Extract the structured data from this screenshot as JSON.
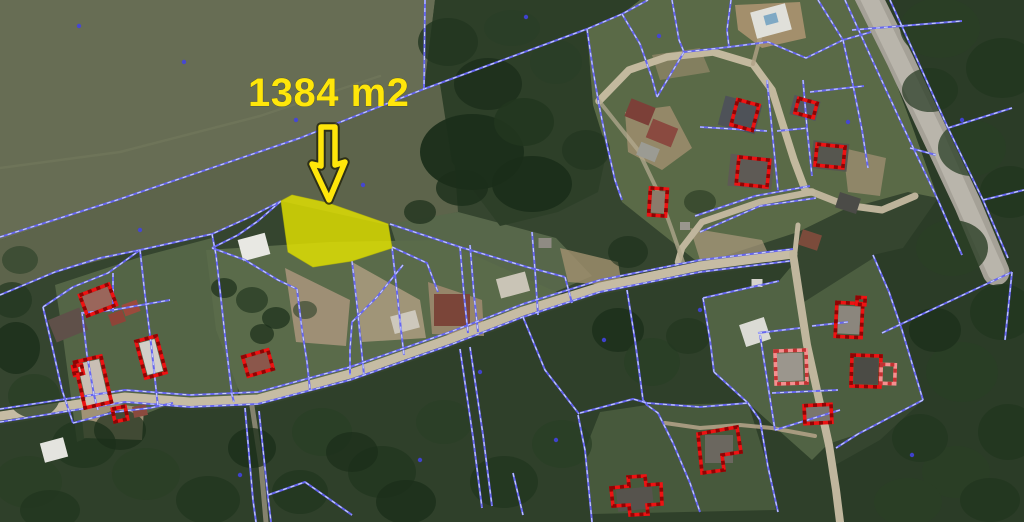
{
  "annotation": {
    "area_label": "1384 m2",
    "arrow_path": "M321,127 L335,127 L335,165 L345,162 L329,200 L312,164 L321,166 Z"
  },
  "colors": {
    "parcel_line": "#6767ef",
    "parcel_line_dash": "#c9d1fc",
    "building_outline": "#ee1212",
    "building_outline_dash": "#8f0404",
    "building_light": "#f58f8f",
    "building_light_dash": "#c23232",
    "highlight_fill": "#e3e300",
    "annotation_yellow": "#ffe60a",
    "canopy": [
      "#22361f",
      "#1b2e1a",
      "#2a3f26",
      "#314a2b"
    ]
  },
  "highlight_parcel": {
    "points": "281,201 292,195 328,203 388,224 392,248 352,261 313,267 288,252"
  },
  "geometry": {
    "patches": [
      {
        "n": "forest-base",
        "p": "0,0 1024,0 1024,522 0,522",
        "f": "#35452f"
      },
      {
        "n": "field-upper",
        "p": "0,0 435,0 424,89 300,140 115,202 0,240",
        "f": "#676d54"
      },
      {
        "n": "field-lower",
        "p": "0,240 115,202 300,140 424,89 440,84 452,125 458,212 392,226 281,201 250,217 212,234 140,250 55,272 0,295",
        "f": "#5d644b"
      },
      {
        "n": "grass-east",
        "p": "390,224 458,212 556,238 592,276 532,302 462,292 400,256",
        "f": "#57674a"
      },
      {
        "n": "top-center-forest",
        "p": "435,0 640,0 622,14 587,29 593,105 607,150 598,192 558,212 500,226 452,162 440,84 424,89",
        "f": "#2d3f28"
      },
      {
        "n": "top-right-grass",
        "p": "640,0 862,0 880,40 910,120 938,198 908,192 843,210 798,232 700,264 622,202 607,150 593,105 587,29 622,14",
        "f": "#5a6a47"
      },
      {
        "n": "right-forest",
        "p": "862,0 1024,0 1024,522 836,522 830,468 880,440 923,400 902,330 873,255 903,248 938,198 910,120 880,40",
        "f": "#2b3c27"
      },
      {
        "n": "bottom-forest",
        "p": "0,425 125,405 190,410 258,407 350,383 450,348 523,320 600,295 700,275 795,262 802,302 814,362 830,446 834,472 840,522 0,522",
        "f": "#2f402a"
      },
      {
        "n": "left-settlement-grass",
        "p": "55,285 140,257 212,238 236,302 238,399 173,403 130,420 77,442 62,330",
        "f": "#546546"
      },
      {
        "n": "central-settlement-grass",
        "p": "206,250 330,242 440,240 570,298 522,314 350,377 242,399 216,330",
        "f": "#5a6b4a"
      },
      {
        "n": "se-parcels-grass",
        "p": "585,450 600,412 647,405 748,403 768,467 776,510 592,514",
        "f": "#47593c"
      },
      {
        "n": "b12-parcel-grass",
        "p": "875,257 902,330 923,400 858,434 828,444 812,362 804,302",
        "f": "#4c5e40"
      },
      {
        "n": "br-settlement-grass",
        "p": "703,298 779,281 795,262 802,302 814,362 828,444 812,460 748,403 714,372",
        "f": "#516344"
      }
    ],
    "dirt": [
      {
        "p": "735,5 800,2 806,38 762,48 738,30",
        "f": "#a8916f",
        "o": 0.95
      },
      {
        "p": "625,112 670,106 692,148 662,170 628,152",
        "f": "#a39070",
        "o": 0.8
      },
      {
        "p": "690,228 762,240 772,262 700,260",
        "f": "#ab9a7e",
        "o": 0.7
      },
      {
        "p": "285,268 350,300 346,346 296,342",
        "f": "#a5947a",
        "o": 0.9
      },
      {
        "p": "352,262 420,300 426,338 362,342",
        "f": "#ad9c80",
        "o": 0.85
      },
      {
        "p": "428,282 482,300 484,336 432,334",
        "f": "#9c8a6e",
        "o": 0.9
      },
      {
        "p": "80,398 144,408 142,440 84,438",
        "f": "#a8977b",
        "o": 0.9
      },
      {
        "p": "843,148 886,158 880,196 848,192",
        "f": "#a59376",
        "o": 0.7
      },
      {
        "p": "652,55 700,48 710,72 660,80",
        "f": "#9f8e6f",
        "o": 0.6
      },
      {
        "p": "560,248 618,262 622,286 568,282",
        "f": "#a2916f",
        "o": 0.8
      }
    ],
    "roads": [
      {
        "n": "main-street-road",
        "p": "0,416 125,397 190,402 258,399 350,374 450,339 523,311 600,287 700,266 793,254",
        "w": 9,
        "c": "#c6bca4",
        "o": 1
      },
      {
        "n": "north-south-street-road",
        "p": "793,254 800,300 807,345 818,395 829,445 836,490 840,522",
        "w": 8,
        "c": "#c0b69d",
        "o": 1
      },
      {
        "n": "loop-road",
        "p": "599,101 629,70 667,57 713,52 753,64 772,90 782,122 794,160 806,192 812,192",
        "w": 7.5,
        "c": "#c3b99e",
        "o": 1
      },
      {
        "n": "loop-road-east",
        "p": "812,192 845,205 882,210 915,196",
        "w": 7,
        "c": "#bdb39a",
        "o": 1
      },
      {
        "n": "connector-road",
        "p": "812,192 760,202 702,222 682,248 678,262",
        "w": 6.5,
        "c": "#c0b69d",
        "o": 1
      },
      {
        "n": "connector-road",
        "p": "798,225 795,252",
        "w": 5,
        "c": "#c0b69d",
        "o": 1
      },
      {
        "n": "west-path-road",
        "p": "599,101 638,150 659,194 672,230 683,262",
        "w": 4,
        "c": "#b3a98f",
        "o": 0.75
      },
      {
        "n": "south-lane-road",
        "p": "252,406 261,465 266,522",
        "w": 5,
        "c": "#9a9280",
        "o": 0.8
      },
      {
        "n": "paved-road",
        "p": "866,-8 900,60 935,135 968,205 996,272",
        "w": 27,
        "c": "#a5a197",
        "o": 1
      },
      {
        "n": "paved-road-surface",
        "p": "866,-8 935,135 996,272",
        "w": 17,
        "c": "#b9b5ab",
        "o": 1
      },
      {
        "n": "driveway",
        "p": "665,423 700,428 740,425 772,428 815,436",
        "w": 4,
        "c": "#b0a186",
        "o": 0.9
      },
      {
        "n": "driveway",
        "p": "753,64 760,38",
        "w": 4,
        "c": "#b0a186",
        "o": 0.8
      },
      {
        "n": "field-trail",
        "p": "0,168 120,152 260,116 380,76",
        "w": 2.5,
        "c": "#757b5e",
        "o": 0.5
      }
    ],
    "canopies": [
      [
        472,
        152,
        52,
        38,
        1,
        0.95
      ],
      [
        532,
        184,
        40,
        28,
        1,
        0.9
      ],
      [
        448,
        42,
        30,
        24,
        0,
        0.8
      ],
      [
        488,
        84,
        34,
        26,
        1,
        0.8
      ],
      [
        524,
        122,
        30,
        24,
        0,
        0.85
      ],
      [
        556,
        62,
        26,
        22,
        2,
        0.7
      ],
      [
        586,
        150,
        24,
        20,
        0,
        0.7
      ],
      [
        462,
        188,
        26,
        18,
        1,
        0.8
      ],
      [
        512,
        28,
        28,
        18,
        2,
        0.7
      ],
      [
        940,
        28,
        40,
        30,
        2,
        0.8
      ],
      [
        1002,
        68,
        36,
        30,
        0,
        0.8
      ],
      [
        972,
        148,
        34,
        28,
        2,
        0.75
      ],
      [
        1010,
        192,
        30,
        26,
        0,
        0.8
      ],
      [
        952,
        248,
        36,
        28,
        2,
        0.8
      ],
      [
        1002,
        312,
        32,
        28,
        0,
        0.8
      ],
      [
        962,
        372,
        36,
        30,
        2,
        0.75
      ],
      [
        1008,
        432,
        30,
        28,
        0,
        0.8
      ],
      [
        956,
        472,
        34,
        26,
        2,
        0.8
      ],
      [
        920,
        438,
        28,
        24,
        0,
        0.7
      ],
      [
        908,
        502,
        34,
        24,
        2,
        0.8
      ],
      [
        990,
        500,
        30,
        22,
        0,
        0.8
      ],
      [
        930,
        90,
        28,
        22,
        0,
        0.7
      ],
      [
        935,
        330,
        26,
        22,
        1,
        0.7
      ],
      [
        28,
        482,
        34,
        26,
        2,
        0.8
      ],
      [
        84,
        444,
        32,
        24,
        0,
        0.8
      ],
      [
        146,
        474,
        34,
        26,
        2,
        0.8
      ],
      [
        208,
        500,
        32,
        24,
        0,
        0.8
      ],
      [
        322,
        432,
        30,
        24,
        2,
        0.75
      ],
      [
        382,
        472,
        34,
        26,
        0,
        0.8
      ],
      [
        444,
        422,
        28,
        22,
        2,
        0.7
      ],
      [
        504,
        482,
        34,
        26,
        0,
        0.8
      ],
      [
        562,
        444,
        30,
        24,
        2,
        0.75
      ],
      [
        406,
        502,
        30,
        22,
        1,
        0.8
      ],
      [
        300,
        492,
        28,
        22,
        0,
        0.8
      ],
      [
        252,
        448,
        24,
        20,
        1,
        0.75
      ],
      [
        352,
        452,
        26,
        20,
        1,
        0.7
      ],
      [
        120,
        430,
        26,
        20,
        1,
        0.7
      ],
      [
        50,
        510,
        30,
        20,
        0,
        0.8
      ],
      [
        618,
        330,
        26,
        22,
        1,
        0.8
      ],
      [
        652,
        362,
        28,
        24,
        2,
        0.75
      ],
      [
        688,
        336,
        22,
        18,
        0,
        0.7
      ],
      [
        628,
        252,
        20,
        16,
        1,
        0.6
      ],
      [
        16,
        348,
        24,
        26,
        1,
        0.8
      ],
      [
        34,
        396,
        26,
        22,
        2,
        0.75
      ],
      [
        12,
        300,
        20,
        18,
        0,
        0.7
      ],
      [
        20,
        260,
        18,
        14,
        2,
        0.6
      ],
      [
        252,
        300,
        16,
        13,
        2,
        0.8
      ],
      [
        276,
        318,
        14,
        11,
        0,
        0.8
      ],
      [
        224,
        288,
        13,
        10,
        1,
        0.7
      ],
      [
        262,
        334,
        12,
        10,
        1,
        0.7
      ],
      [
        305,
        310,
        12,
        9,
        2,
        0.6
      ],
      [
        420,
        212,
        16,
        12,
        1,
        0.7
      ],
      [
        700,
        202,
        16,
        12,
        1,
        0.5
      ]
    ],
    "pads": [
      [
        254,
        247,
        28,
        22,
        -15,
        "#e8e8e3"
      ],
      [
        54,
        450,
        24,
        20,
        -15,
        "#e4e4df"
      ],
      [
        755,
        332,
        26,
        23,
        -18,
        "#dbdbd5"
      ],
      [
        771,
        21,
        36,
        27,
        -15,
        "#e0e0da"
      ],
      [
        771,
        19,
        13,
        10,
        -15,
        "#7fa9c4"
      ],
      [
        513,
        285,
        30,
        20,
        -15,
        "#c9c4b6"
      ],
      [
        405,
        322,
        26,
        18,
        -15,
        "#cdc8bc"
      ],
      [
        545,
        243,
        13,
        10,
        0,
        "#8f8b83"
      ],
      [
        757,
        283,
        11,
        8,
        0,
        "#d6d4cd"
      ],
      [
        685,
        226,
        10,
        8,
        0,
        "#9a968e"
      ]
    ],
    "roofs": [
      [
        640,
        112,
        26,
        19,
        22,
        "#7c4038"
      ],
      [
        662,
        133,
        27,
        20,
        22,
        "#8a4a40"
      ],
      [
        648,
        152,
        20,
        14,
        22,
        "#9b9b93"
      ],
      [
        740,
        115,
        38,
        30,
        15,
        "#4e5258"
      ],
      [
        805,
        108,
        27,
        20,
        15,
        "#54575c"
      ],
      [
        830,
        156,
        36,
        28,
        6,
        "#56564f"
      ],
      [
        751,
        172,
        44,
        32,
        6,
        "#5e5a55"
      ],
      [
        658,
        202,
        13,
        22,
        4,
        "#8b7b6b"
      ],
      [
        848,
        203,
        22,
        16,
        18,
        "#4b4b47"
      ],
      [
        810,
        240,
        20,
        16,
        18,
        "#7b4b3b"
      ],
      [
        68,
        325,
        34,
        24,
        -22,
        "#5f5049"
      ],
      [
        98,
        300,
        27,
        18,
        -21,
        "#9a665b"
      ],
      [
        131,
        308,
        16,
        12,
        -20,
        "#9c4a3c"
      ],
      [
        117,
        318,
        15,
        12,
        -20,
        "#8e4438"
      ],
      [
        93,
        382,
        22,
        42,
        -13,
        "#c9beb4"
      ],
      [
        151,
        357,
        16,
        33,
        -15,
        "#d2cfc8"
      ],
      [
        258,
        363,
        22,
        16,
        -16,
        "#8b574b"
      ],
      [
        140,
        411,
        14,
        11,
        -12,
        "#8a4a3e"
      ],
      [
        452,
        310,
        36,
        32,
        0,
        "#7b4539"
      ],
      [
        849,
        320,
        22,
        28,
        3,
        "#8b867d"
      ],
      [
        866,
        371,
        24,
        26,
        2,
        "#4b4b45"
      ],
      [
        790,
        367,
        26,
        28,
        -2,
        "#9b968d"
      ],
      [
        818,
        414,
        24,
        15,
        -3,
        "#7b766d"
      ],
      [
        719,
        449,
        28,
        28,
        0,
        "#6b675f"
      ],
      [
        635,
        499,
        36,
        22,
        -6,
        "#56534d"
      ]
    ],
    "survey_dots": [
      [
        79,
        26
      ],
      [
        526,
        17
      ],
      [
        659,
        36
      ],
      [
        363,
        185
      ],
      [
        140,
        230
      ],
      [
        480,
        372
      ],
      [
        700,
        310
      ],
      [
        912,
        455
      ],
      [
        240,
        475
      ],
      [
        556,
        440
      ],
      [
        962,
        120
      ],
      [
        848,
        122
      ],
      [
        296,
        120
      ],
      [
        184,
        62
      ],
      [
        604,
        340
      ],
      [
        420,
        460
      ]
    ],
    "parcel_lines": [
      "0,237 117,200 300,138 424,89 587,29 622,14 648,0",
      "425,0 424,89",
      "0,295 55,272 100,258 140,250 212,234 250,217 281,201",
      "281,201 258,221 238,235 212,248",
      "212,248 245,260 278,280 297,289",
      "297,289 302,330 307,362 310,390",
      "352,261 357,305 361,345 364,375",
      "392,247 397,292 401,330 404,355",
      "390,224 460,247 527,267 565,277",
      "460,247 464,295 468,333",
      "470,245 474,295 478,332",
      "532,232 535,270 537,300 538,315",
      "392,247 427,263 438,292",
      "565,277 572,303",
      "0,409 125,390 190,395 258,392 350,367 450,332 523,304 600,280 700,260 793,249",
      "0,422 125,402 190,407 258,404 350,380 450,345 523,317 600,292 700,272 790,261",
      "245,408 253,500 256,522",
      "259,411 268,497 271,522",
      "268,495 305,482 352,515",
      "43,307 73,287 108,273 140,250",
      "43,307 53,350 62,390 73,423",
      "73,423 115,412 150,408 173,403",
      "140,250 145,295 150,335 154,370 158,407",
      "82,312 87,355 94,395 98,410",
      "82,313 113,310 170,300",
      "113,273 113,312",
      "212,234 216,255 220,290 226,345 232,395 234,402",
      "587,29 593,70 599,105 607,145 615,180 622,200",
      "622,14 640,44 652,78 657,97",
      "672,0 679,40 684,52",
      "731,0 727,30 729,47",
      "657,97 684,52 729,47 768,42 806,58 843,40 871,32",
      "818,0 843,40",
      "843,40 853,85 862,130 868,168",
      "810,92 864,86",
      "845,0 870,55 900,120 938,200 962,255",
      "890,0 915,55 948,128 983,200 1008,258",
      "852,30 962,21",
      "910,148 936,155",
      "948,128 1012,108",
      "983,200 1024,190",
      "700,127 767,131",
      "777,131 808,128",
      "767,80 772,130 778,190",
      "803,80 807,128 812,176",
      "695,216 755,196 810,186",
      "700,232 760,206 816,198",
      "703,298 779,281",
      "703,298 710,340 714,372",
      "714,372 748,403",
      "748,403 760,420 768,467 778,512",
      "647,403 700,407 748,403",
      "627,290 635,340 643,400 647,405 658,413 673,443 690,483 700,512",
      "578,415 585,450 592,522",
      "580,413 633,399 647,403",
      "523,317 545,370 579,414",
      "460,349 473,437 482,508",
      "470,347 483,435 492,506",
      "513,473 523,515",
      "403,265 377,297 352,322 350,350 350,375",
      "873,255 889,292 902,330 923,400",
      "923,400 858,434",
      "858,434 836,448",
      "882,333 948,302 1012,272",
      "1012,272 1005,340",
      "772,393 838,390",
      "758,333 800,328",
      "812,326 848,322",
      "760,335 775,430",
      "775,430 840,410"
    ],
    "buildings": [
      {
        "r": [
          745,
          115,
          22,
          26,
          15
        ]
      },
      {
        "r": [
          806,
          108,
          19,
          15,
          15
        ]
      },
      {
        "r": [
          830,
          156,
          28,
          21,
          6
        ]
      },
      {
        "r": [
          753,
          172,
          31,
          27,
          6
        ]
      },
      {
        "r": [
          658,
          202,
          17,
          27,
          4
        ]
      },
      {
        "r": [
          98,
          300,
          31,
          22,
          -21
        ]
      },
      {
        "r": [
          93,
          382,
          27,
          47,
          -13
        ]
      },
      {
        "r": [
          78,
          370,
          9,
          9,
          -13
        ]
      },
      {
        "r": [
          120,
          414,
          13,
          13,
          -12
        ]
      },
      {
        "r": [
          151,
          357,
          21,
          38,
          -15
        ]
      },
      {
        "r": [
          258,
          363,
          26,
          20,
          -16
        ]
      },
      {
        "r": [
          849,
          320,
          26,
          34,
          3
        ]
      },
      {
        "r": [
          861,
          301,
          8,
          7,
          3
        ]
      },
      {
        "r": [
          866,
          371,
          29,
          31,
          2
        ]
      },
      {
        "r": [
          888,
          374,
          14,
          19,
          2
        ],
        "l": 1
      },
      {
        "r": [
          791,
          367,
          31,
          33,
          -2
        ],
        "l": 1
      },
      {
        "r": [
          818,
          414,
          27,
          18,
          -3
        ]
      },
      {
        "p": "698,434 737,427 741,452 722,455 724,470 702,473"
      },
      {
        "p": "611,488 629,486 628,477 645,476 646,485 661,484 662,504 647,505 648,514 630,515 629,505 613,506"
      }
    ]
  }
}
